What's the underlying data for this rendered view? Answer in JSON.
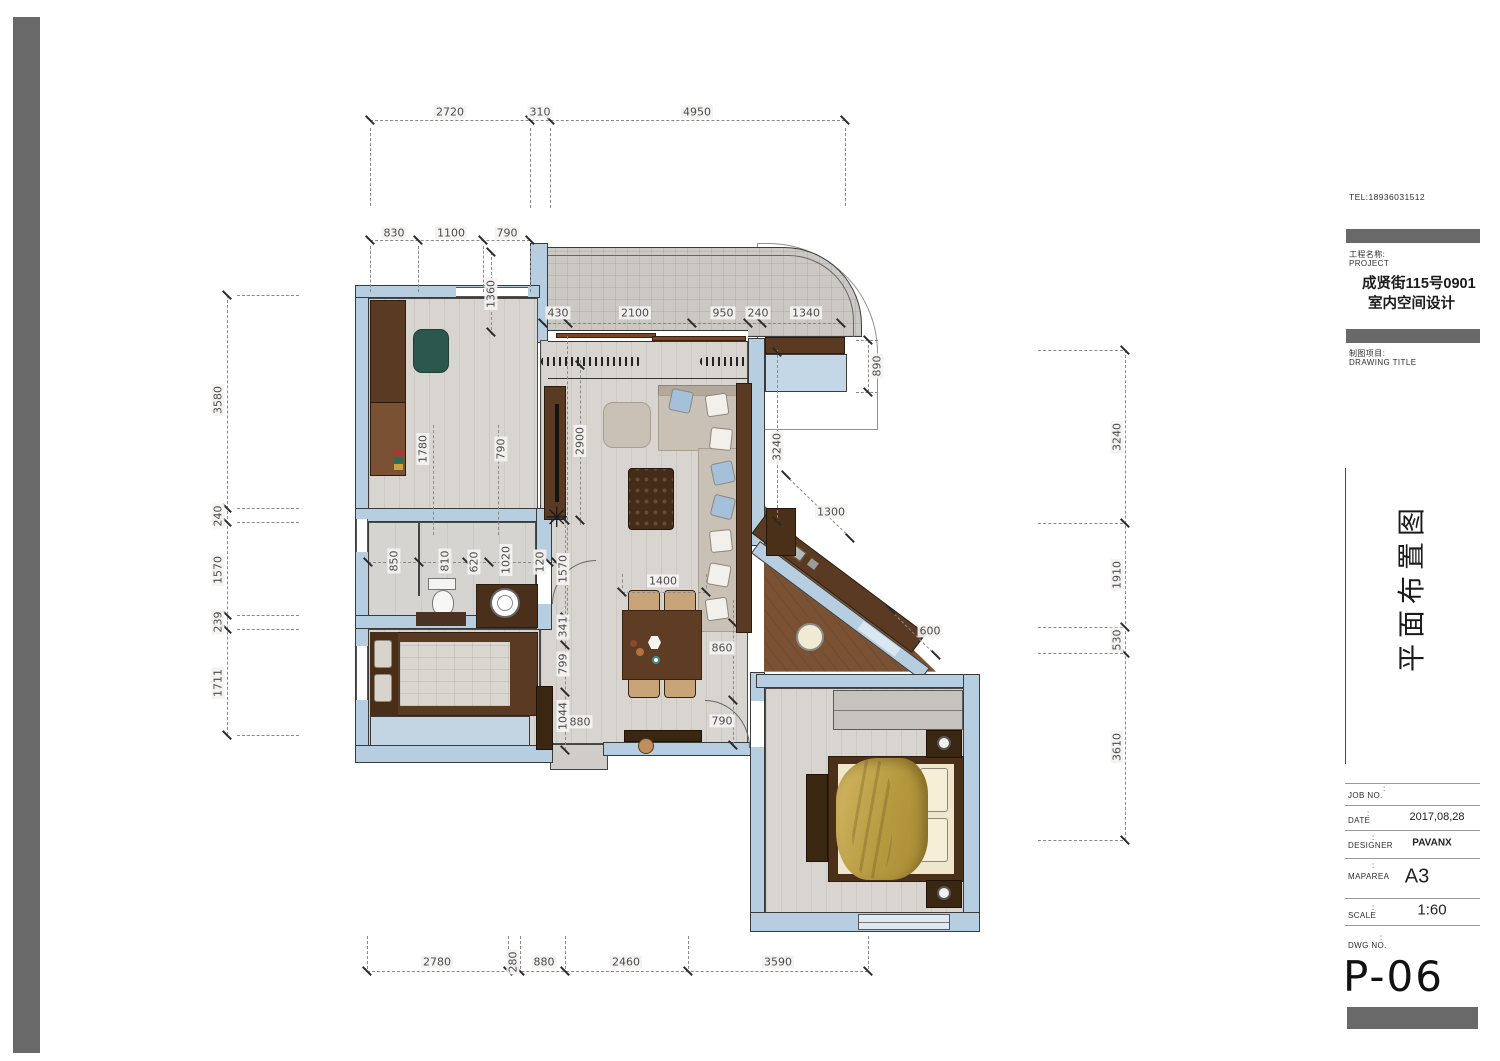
{
  "title_block": {
    "tel": "TEL:18936031512",
    "colon": ":",
    "project_label_cn": "工程名称:",
    "project_label_en": "PROJECT",
    "project_name": "成贤街115号0901",
    "project_subtitle": "室内空间设计",
    "drawing_label_cn": "制图项目:",
    "drawing_label_en": "DRAWING TITLE",
    "drawing_title": "平面布置图",
    "rows": [
      {
        "label": "JOB NO.",
        "value": ""
      },
      {
        "label": "DATE",
        "value": "2017,08,28"
      },
      {
        "label": "DESIGNER",
        "value": "PAVANX"
      },
      {
        "label": "MAPAREA",
        "value": "A3"
      },
      {
        "label": "SCALE",
        "value": "1:60"
      },
      {
        "label": "DWG NO.",
        "value": ""
      }
    ],
    "drawing_number": "P-06"
  },
  "dims": {
    "top_row": [
      "2720",
      "310",
      "4950"
    ],
    "upper_row": [
      "830",
      "1100",
      "790"
    ],
    "left_col": [
      "3580",
      "240",
      "1570",
      "239",
      "1711"
    ],
    "right_col": [
      "3240",
      "1910",
      "530",
      "3610"
    ],
    "bottom_row": [
      "2780",
      "280",
      "880",
      "2460",
      "3590"
    ],
    "balcony_row": [
      "430",
      "2100",
      "950",
      "240",
      "1340"
    ],
    "bath_row": [
      "850",
      "810",
      "620",
      "1020",
      "120"
    ],
    "hall_col": [
      "1570",
      "341",
      "799",
      "1044"
    ],
    "interior": {
      "d1360": "1360",
      "d890": "890",
      "d1780": "1780",
      "d790a": "790",
      "d2900": "2900",
      "d3240": "3240",
      "d1300": "1300",
      "d1400": "1400",
      "d860": "860",
      "d790b": "790",
      "d600": "600",
      "d880": "880"
    }
  },
  "colors": {
    "wall": "#b7cde0",
    "wall_border": "#3a3a3a",
    "floor": "#d8d5d0",
    "balcony": "#ccc9c5",
    "wood_dark": "#5a3a22",
    "wood_mid": "#7a5233",
    "wood_deep": "#3a2712",
    "sofa": "#cac1b6",
    "pillow": "#f2f0ea",
    "pillow_blue": "#a4c0da",
    "chair_green": "#2c574c",
    "blanket": "#bda04a",
    "mattress": "#efe7cd",
    "mattress_gray": "#dad7d1",
    "bar_gray": "#696969",
    "dim_text": "#4c4c4c",
    "dash": "#8a8a8a",
    "tick": "#2a2a2a"
  }
}
